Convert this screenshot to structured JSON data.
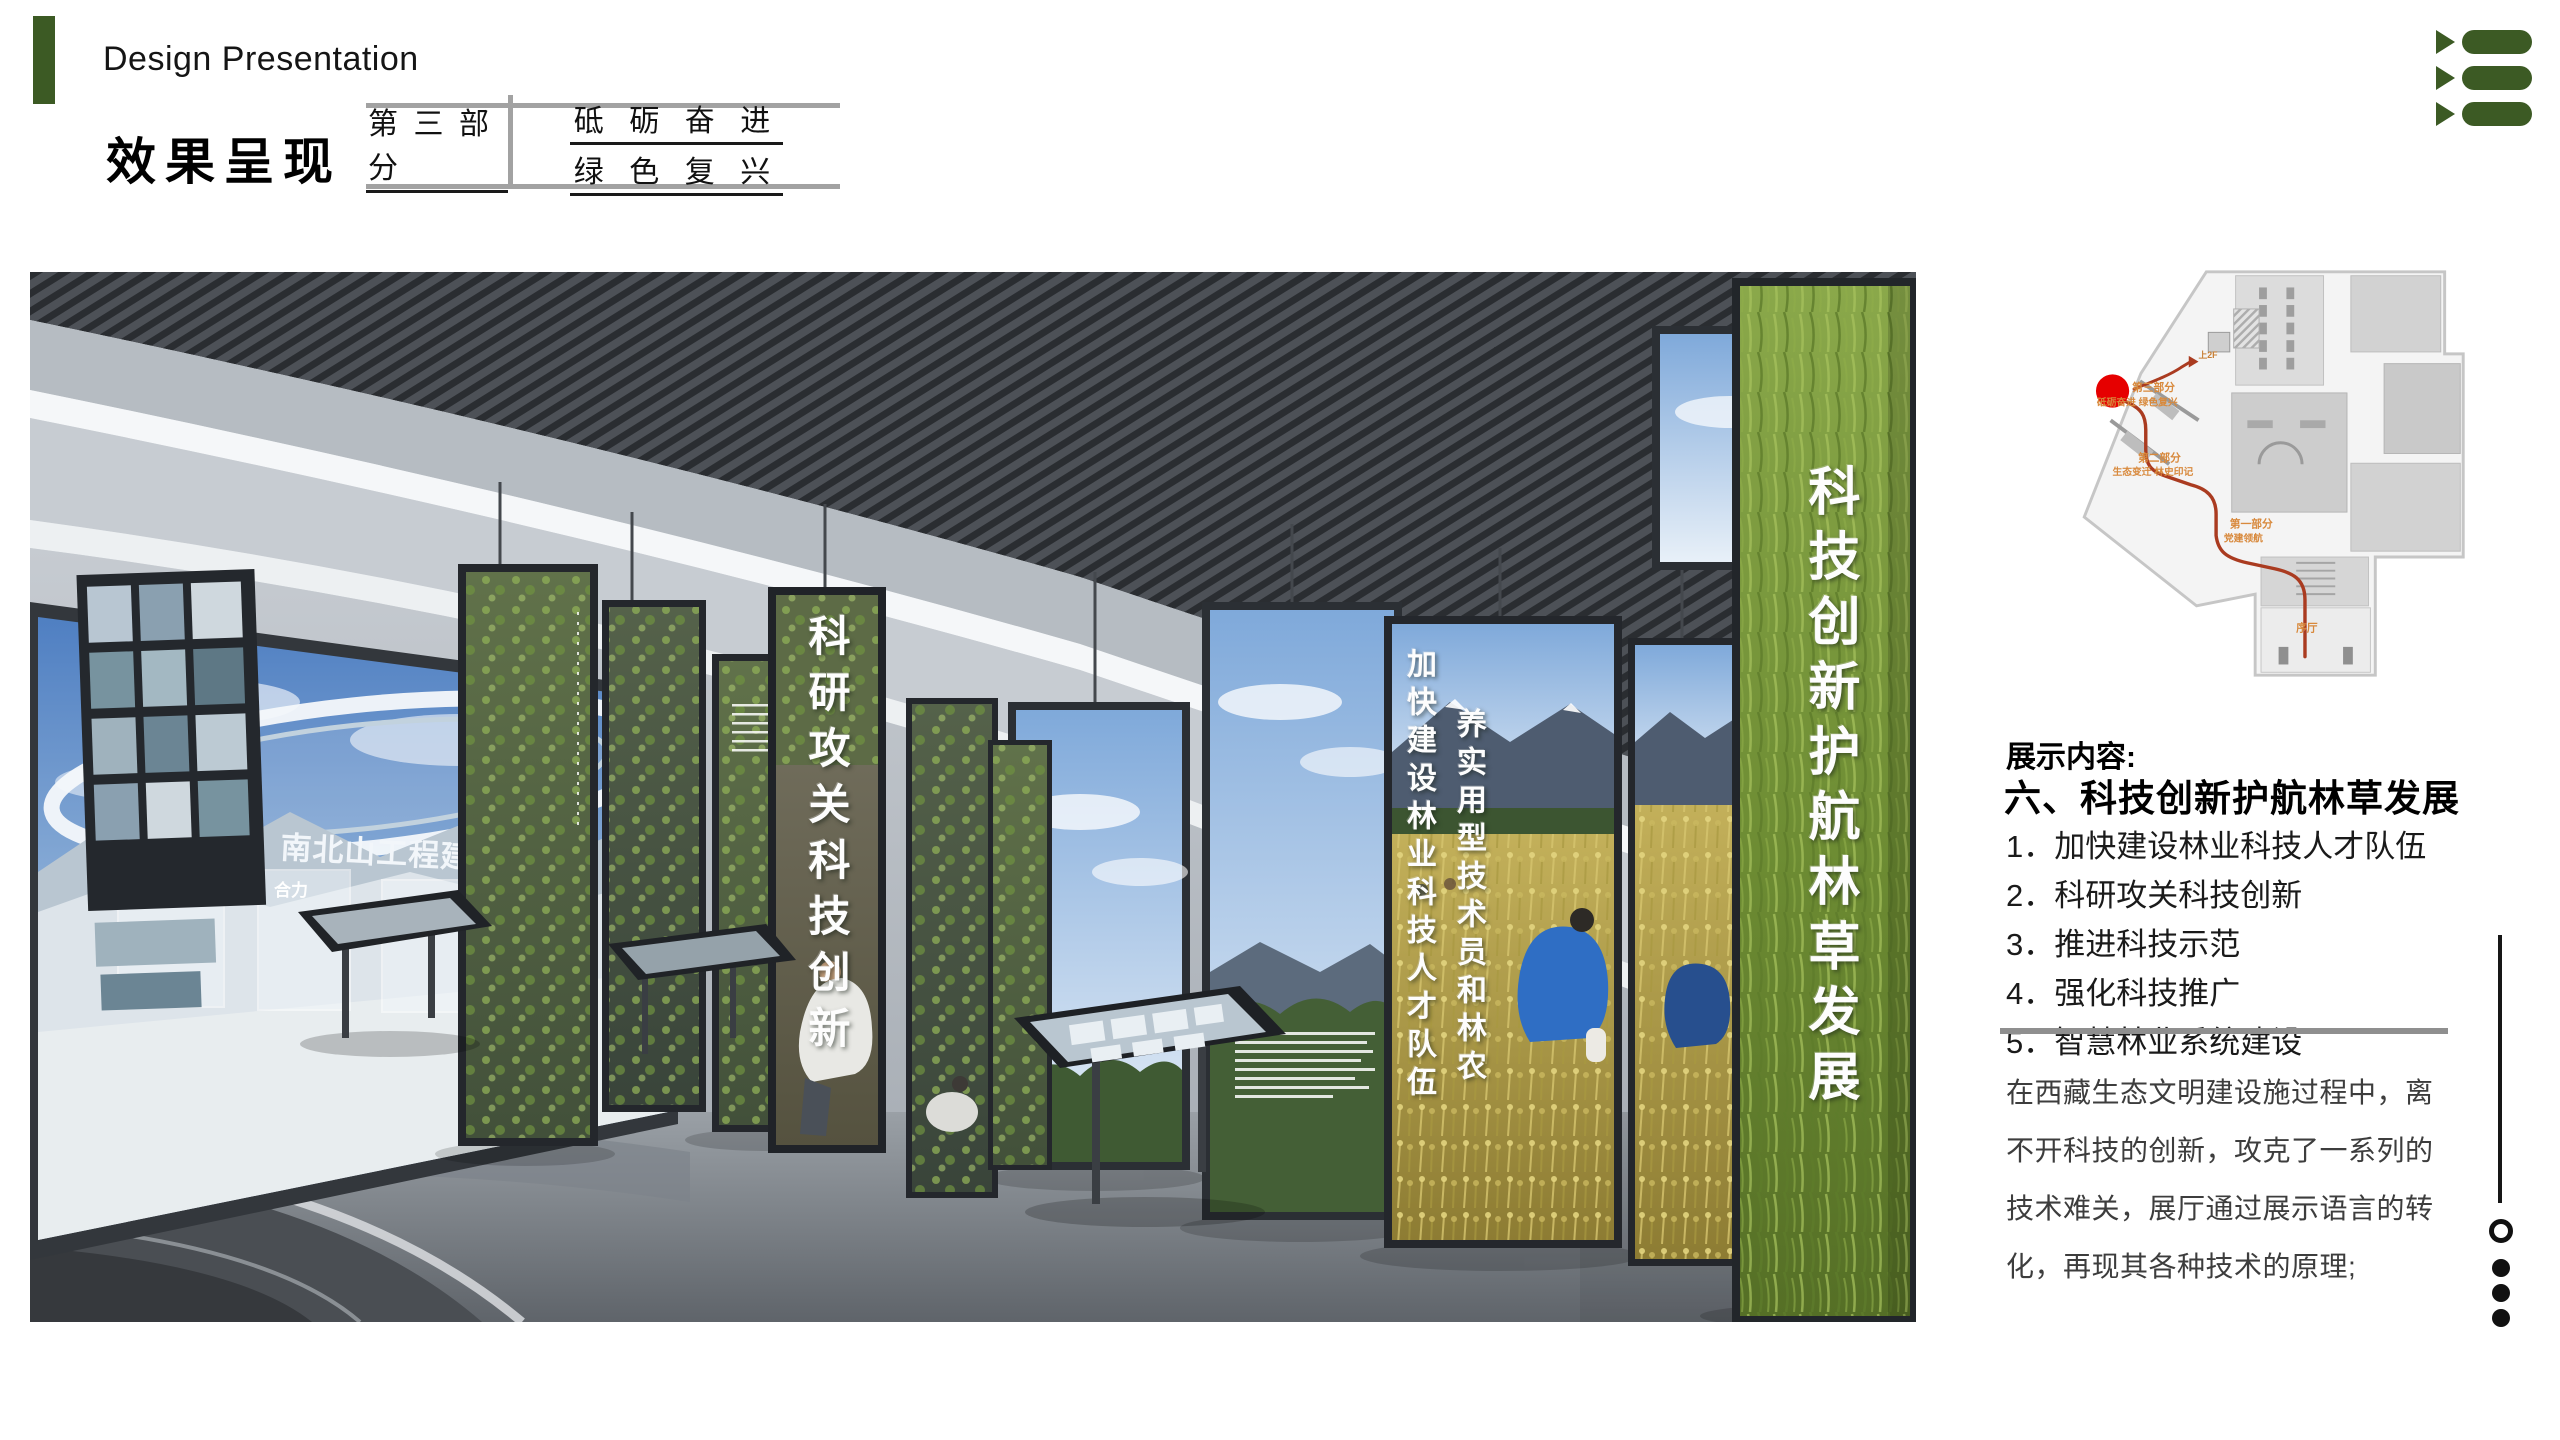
{
  "header": {
    "brand": "Design Presentation",
    "title": "效果呈现",
    "part_label": "第 三 部 分",
    "slogan_line1": "砥 砺 奋 进",
    "slogan_line2": "绿 色 复 兴"
  },
  "menu": {
    "icon": "list-menu-icon",
    "color": "#3c5a24"
  },
  "scene": {
    "left_screen": {
      "title": "南北山工程建设过程",
      "caption_en": "Construc",
      "tag1": "谋划",
      "tag2": "合力"
    },
    "pillars": {
      "research": "科研攻关科技创新",
      "talent_col1": "加快建设林业科技人才队伍",
      "talent_col2": "养实用型技术员和林农",
      "theme": "科技创新护航林草发展"
    }
  },
  "plan": {
    "marker_color": "#e60000",
    "route_color": "#aa3b20",
    "label_color": "#d8893c",
    "labels": {
      "part3": "第三部分",
      "part3_sub": "砥砺奋进 绿色复兴",
      "part2": "第二部分",
      "part2_sub": "生态变迁 林史印记",
      "part1": "第一部分",
      "part1_sub": "党建领航",
      "lobby": "序厅",
      "up2f": "上2F"
    }
  },
  "content": {
    "label": "展示内容:",
    "heading": "六、科技创新护航林草发展",
    "items": [
      "1．加快建设林业科技人才队伍",
      "2．科研攻关科技创新",
      "3．推进科技示范",
      "4．强化科技推广",
      "5．智慧林业系统建设"
    ],
    "paragraph": "在西藏生态文明建设施过程中，离不开科技的创新，攻克了一系列的技术难关，展厅通过展示语言的转化，再现其各种技术的原理;"
  },
  "pager": {
    "total_dots": 4,
    "first_dot_style": "hollow",
    "colors": {
      "dot": "#111111"
    }
  },
  "colors": {
    "accent_green": "#3c5a24",
    "table_line": "#a2a2a2",
    "separator_gray": "#8f8f8f"
  }
}
